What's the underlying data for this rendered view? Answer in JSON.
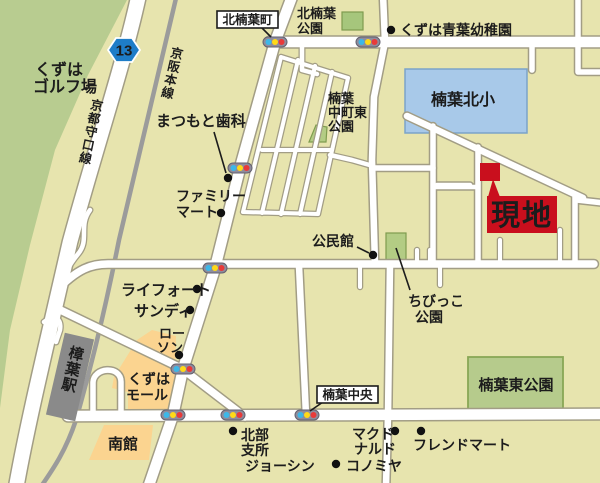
{
  "map": {
    "site": {
      "label": "現地"
    },
    "route_shield": {
      "number": "13"
    },
    "roads": {
      "kyoto_moriguchi_line": "京都守口線",
      "keihan_main_line": "京阪本線",
      "kitakuzuha_cho": "北楠葉町",
      "kuzuha_chuo": "楠葉中央"
    },
    "places": {
      "golf": {
        "l1": "くずは",
        "l2": "ゴルフ場"
      },
      "kita_park": {
        "l1": "北楠葉",
        "l2": "公園"
      },
      "kindergarten": "くずは青葉幼稚園",
      "school": "楠葉北小",
      "nakamachi_park": {
        "l1": "楠葉",
        "l2": "中町東",
        "l3": "公園"
      },
      "dental": "まつもと歯科",
      "familymart": {
        "l1": "ファミリー",
        "l2": "マート"
      },
      "community_hall": "公民館",
      "chibikko_park": {
        "l1": "ちびっこ",
        "l2": "公園"
      },
      "lifort": "ライフォート",
      "sundi": "サンディ",
      "lawson": {
        "l1": "ロー",
        "l2": "ソン"
      },
      "station": "樟葉駅",
      "mall": {
        "l1": "くずは",
        "l2": "モール"
      },
      "higashi_park": "楠葉東公園",
      "minamikan": "南館",
      "hokubu_branch": {
        "l1": "北部",
        "l2": "支所"
      },
      "joshin": "ジョーシン",
      "mcdonalds": {
        "l1": "マクド",
        "l2": "ナルド"
      },
      "friendmart": "フレンドマート",
      "konomiya": "コノミヤ"
    },
    "colors": {
      "background": "#e7e4ae",
      "golf_green": "#b8cc90",
      "park_green": "#b6cb8c",
      "park_border": "#84a354",
      "school_blue": "#a8c9e9",
      "mall_orange": "#fbd490",
      "site_red": "#c90f1d",
      "road_white": "#ffffff",
      "railway_gray": "#9b9b9b",
      "station_gray": "#8a8a8a",
      "signal_body": "#8e8c9c",
      "signal_blue": "#3db7e8",
      "signal_yellow": "#ffd918",
      "signal_red": "#e83a3a",
      "route_shield_blue": "#1e7dc8"
    }
  }
}
